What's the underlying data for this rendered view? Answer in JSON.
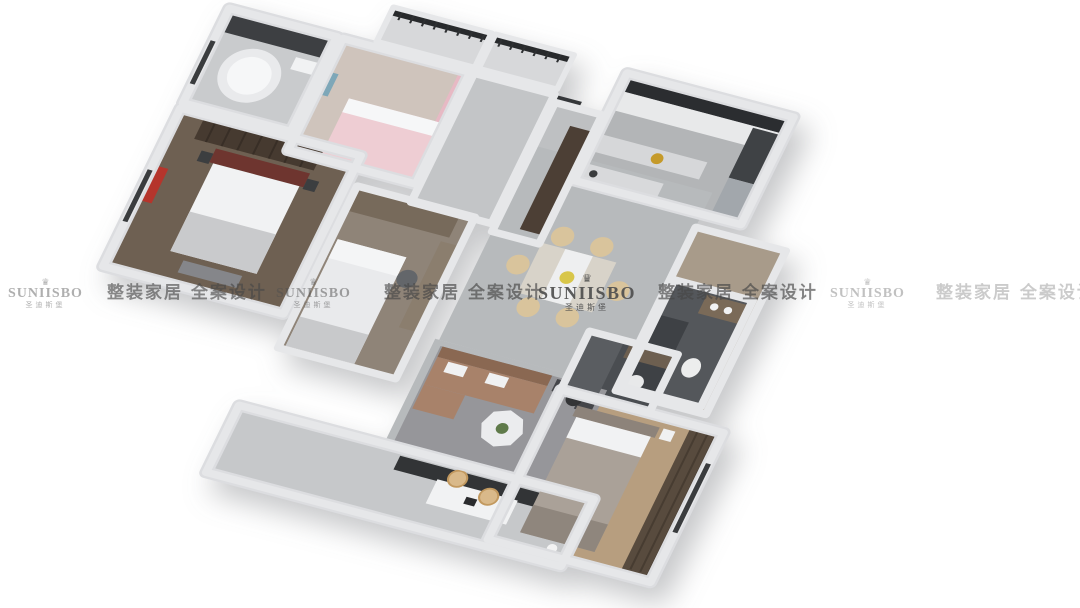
{
  "watermark": {
    "brand": "SUNIISBO",
    "brand_sub": "圣迪斯堡",
    "tagline": "整装家居 全案设计",
    "crown_glyph": "♛",
    "color": "#4f4f4f"
  },
  "scene": {
    "description": "Bird's-eye 3D render of a furnished three-bedroom apartment floor plan on a white background",
    "palette": {
      "background": "#ffffff",
      "wall_light": "#e3e4e6",
      "wall_outer": "#d9dadd",
      "marble_floor": "#b7babc",
      "hall_floor": "#c3c5c7",
      "balcony_floor": "#c6c8ca",
      "wood_floor_dark": "#6e6052",
      "wood_floor_mid": "#8f8478",
      "wood_floor_warm": "#b79e7f",
      "corridor_wood": "#a89b8a",
      "tile_dark": "#54575b",
      "tile_darker": "#4a4d51",
      "sofa_tan": "#a8826a",
      "chair_cream": "#d9c49c",
      "bed_pink": "#eecdd3",
      "curtain_pink": "#e7b9c4",
      "accent_red": "#b5352c",
      "headboard_red": "#6e352f",
      "railing_dark": "#282a2c",
      "cabinet_wood": "#4c3f35",
      "brass": "#c59a2a",
      "rug_gray": "#96969a",
      "tv_console": "#323436",
      "white_furniture": "#f1f2f3"
    },
    "rooms": [
      {
        "name": "corner-tub-bathroom"
      },
      {
        "name": "kids-bedroom"
      },
      {
        "name": "north-balcony-1"
      },
      {
        "name": "north-balcony-2"
      },
      {
        "name": "hallway"
      },
      {
        "name": "entry-foyer"
      },
      {
        "name": "kitchen"
      },
      {
        "name": "master-bedroom"
      },
      {
        "name": "second-bedroom"
      },
      {
        "name": "dining-area"
      },
      {
        "name": "living-room"
      },
      {
        "name": "guest-bathroom"
      },
      {
        "name": "ensuite-bathroom"
      },
      {
        "name": "third-bedroom"
      },
      {
        "name": "south-balcony"
      }
    ]
  }
}
